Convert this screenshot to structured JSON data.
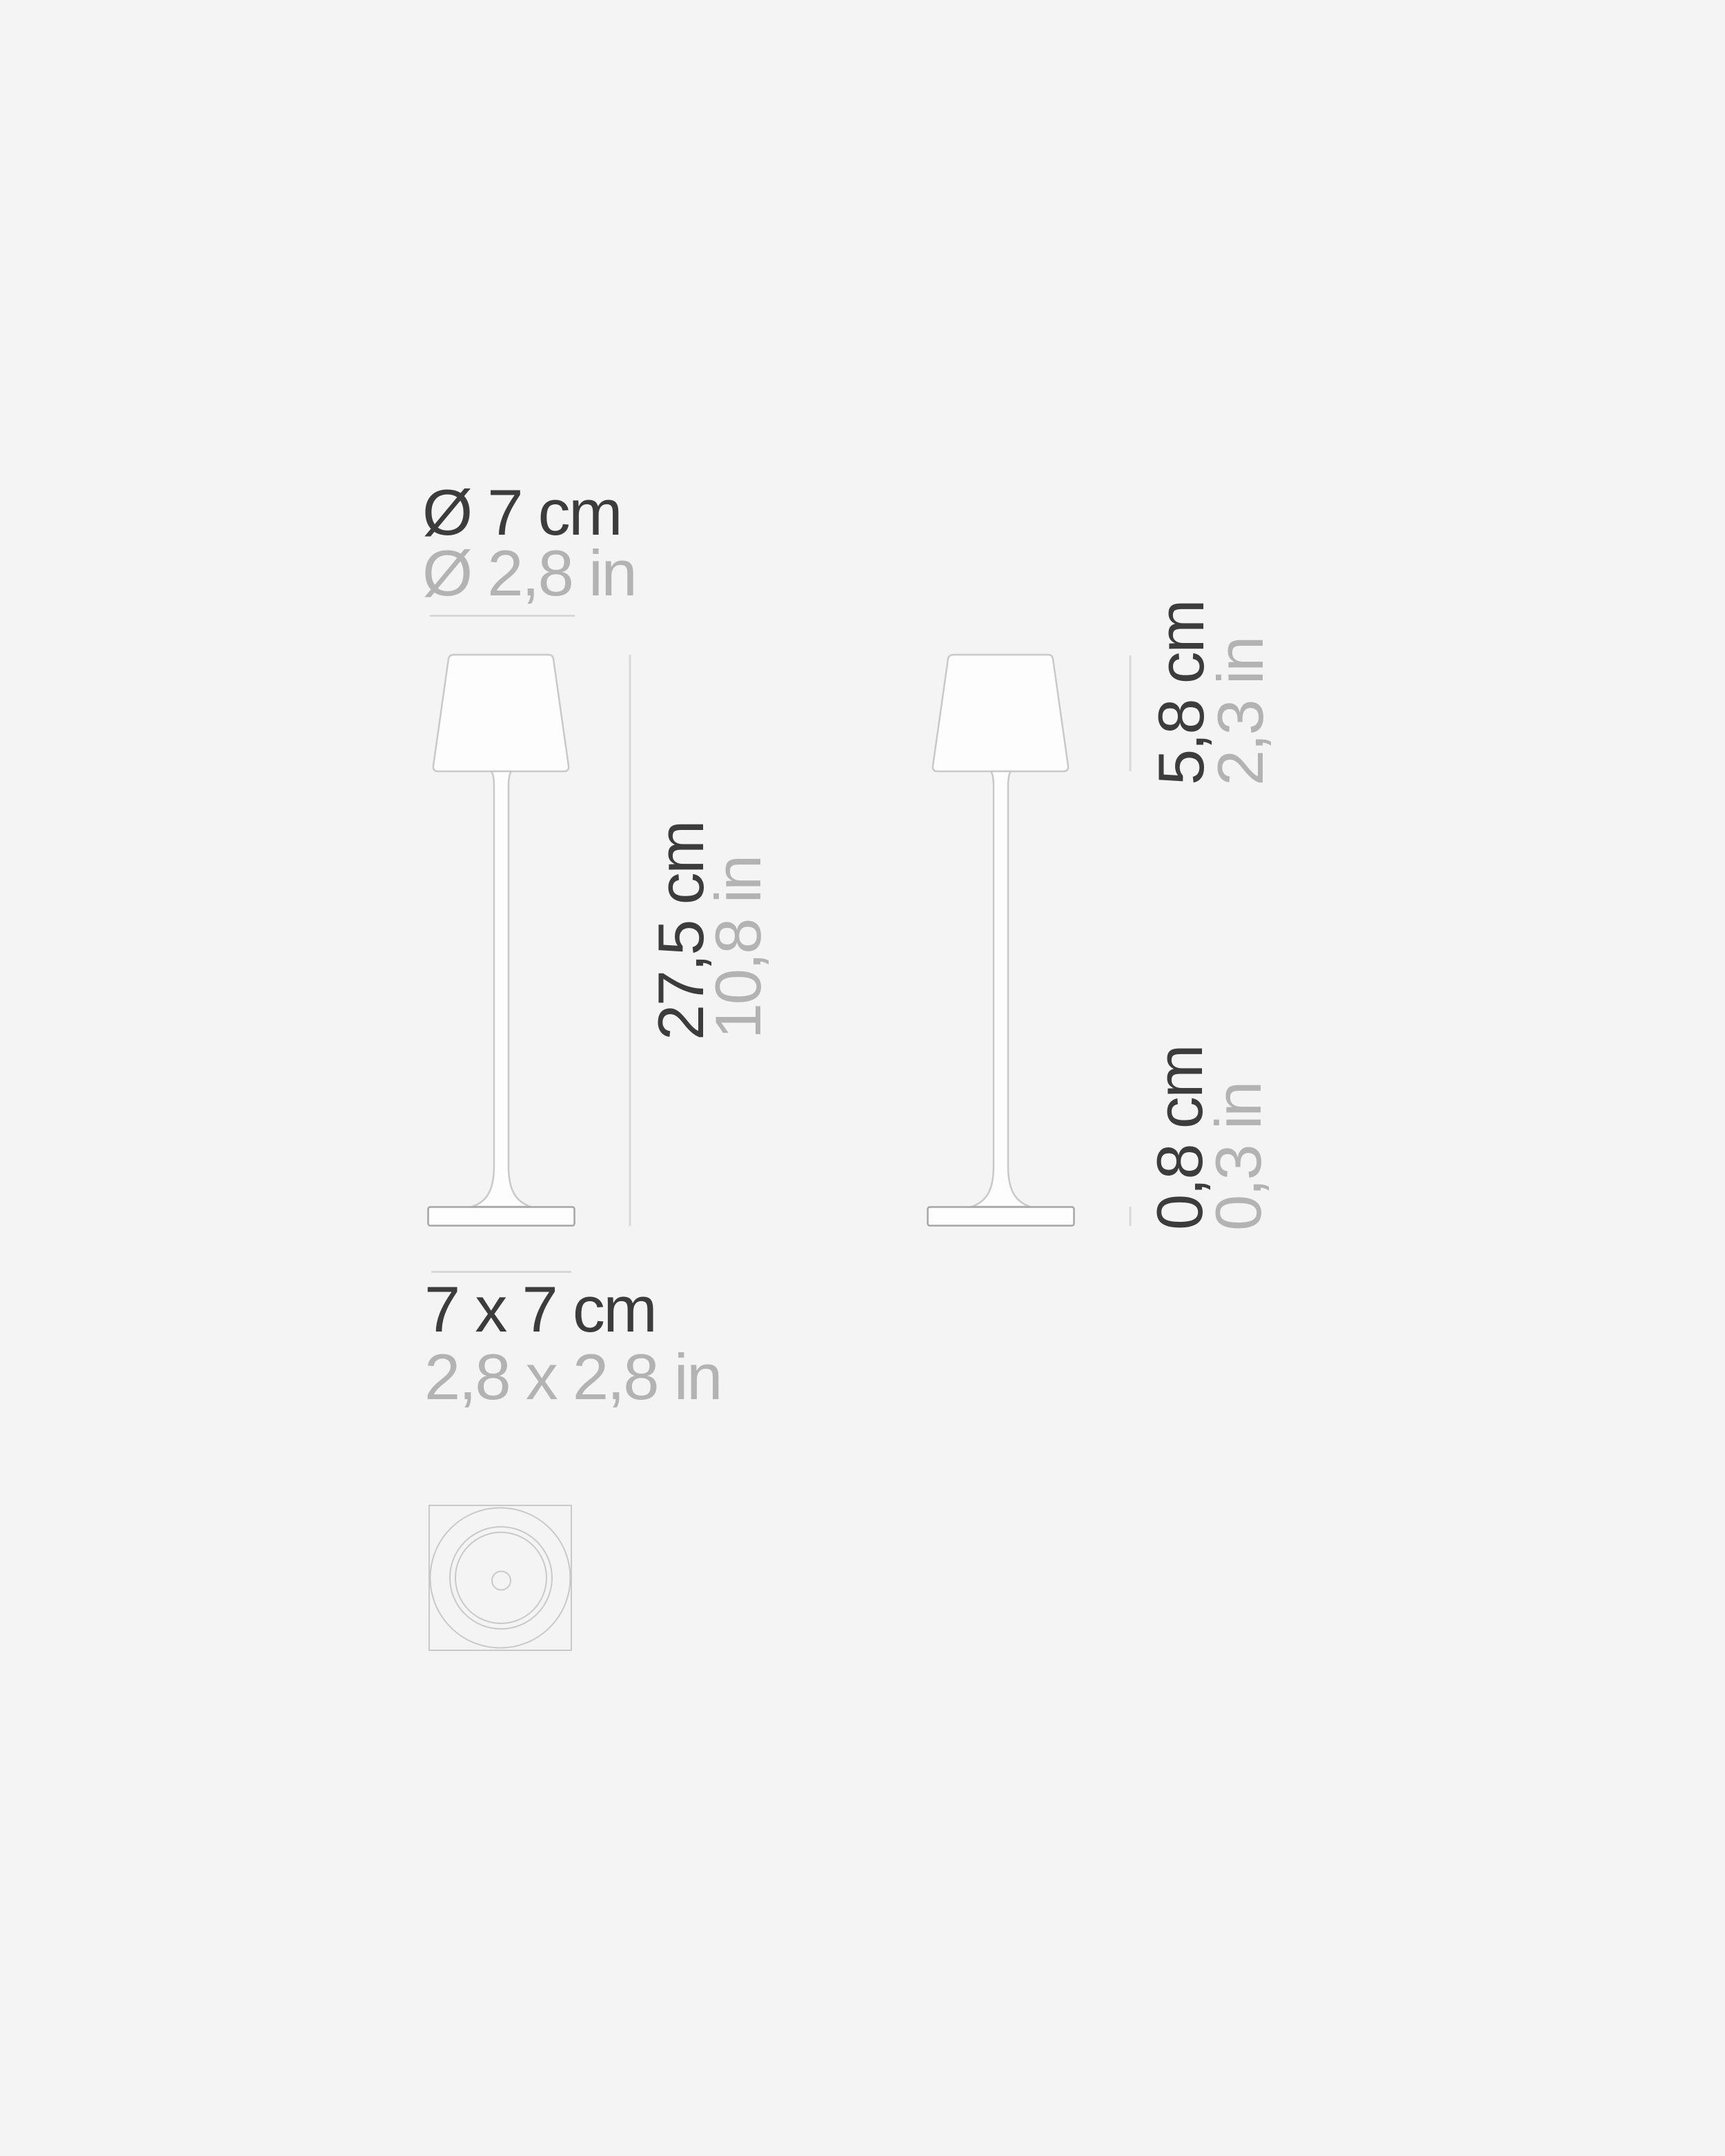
{
  "colors": {
    "background": "#f4f4f4",
    "text_dark": "#3c3c3c",
    "text_light": "#b3b3b3",
    "drawing_line": "#c9c9c9",
    "base_line": "#a5a5a5",
    "dimension_line": "#d8d8d8",
    "shade_fill": "#fdfdfd"
  },
  "labels": {
    "shade_diameter": {
      "metric": "Ø 7 cm",
      "imperial": "Ø 2,8 in"
    },
    "footprint": {
      "metric": "7 x 7 cm",
      "imperial": "2,8 x 2,8 in"
    },
    "total_height": {
      "metric": "27,5 cm",
      "imperial": "10,8 in"
    },
    "shade_height": {
      "metric": "5,8 cm",
      "imperial": "2,3 in"
    },
    "base_height": {
      "metric": "0,8 cm",
      "imperial": "0,3 in"
    }
  }
}
